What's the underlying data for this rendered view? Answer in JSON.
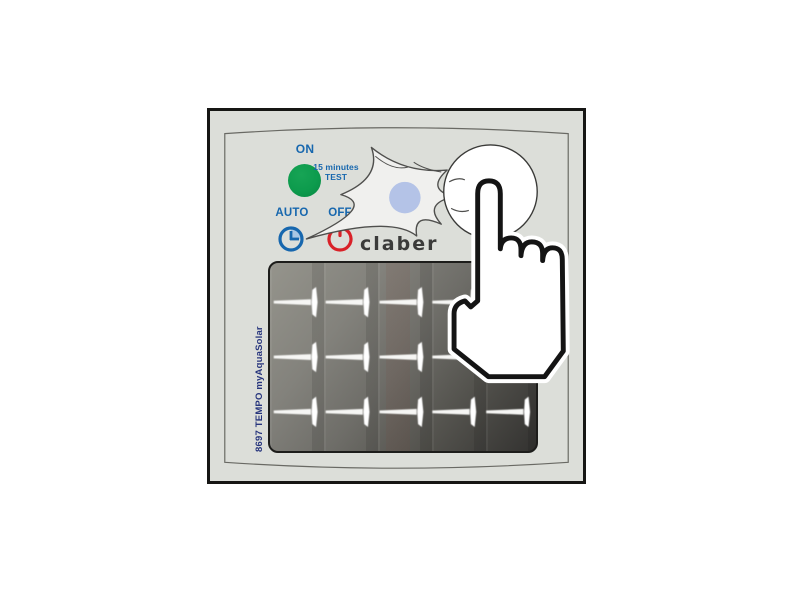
{
  "illustration": {
    "brand_logo": "claber",
    "model_label": "8697 TEMPO myAquaSolar",
    "indicators": {
      "on_label": "ON",
      "test_line1": "15 minutes",
      "test_line2": "TEST",
      "auto_label": "AUTO",
      "off_label": "OFF"
    },
    "icons": {
      "green_led": "green-led",
      "clock": "clock-icon",
      "power": "power-icon",
      "flash_burst": "flash-burst-icon",
      "test_button": "test-button",
      "pointer_hand": "pointer-hand-icon"
    },
    "colors": {
      "device_face": "#dcded9",
      "device_border": "#161614",
      "accent_blue": "#1767ae",
      "led_green": "#0d9b4d",
      "alert_red": "#d92128",
      "button_blue": "#b4c3e7",
      "burst_fill": "#f0f0ee",
      "logo_gray": "#3b3b3a",
      "panel_dark": "#333230",
      "model_text_navy": "#27357d"
    }
  }
}
